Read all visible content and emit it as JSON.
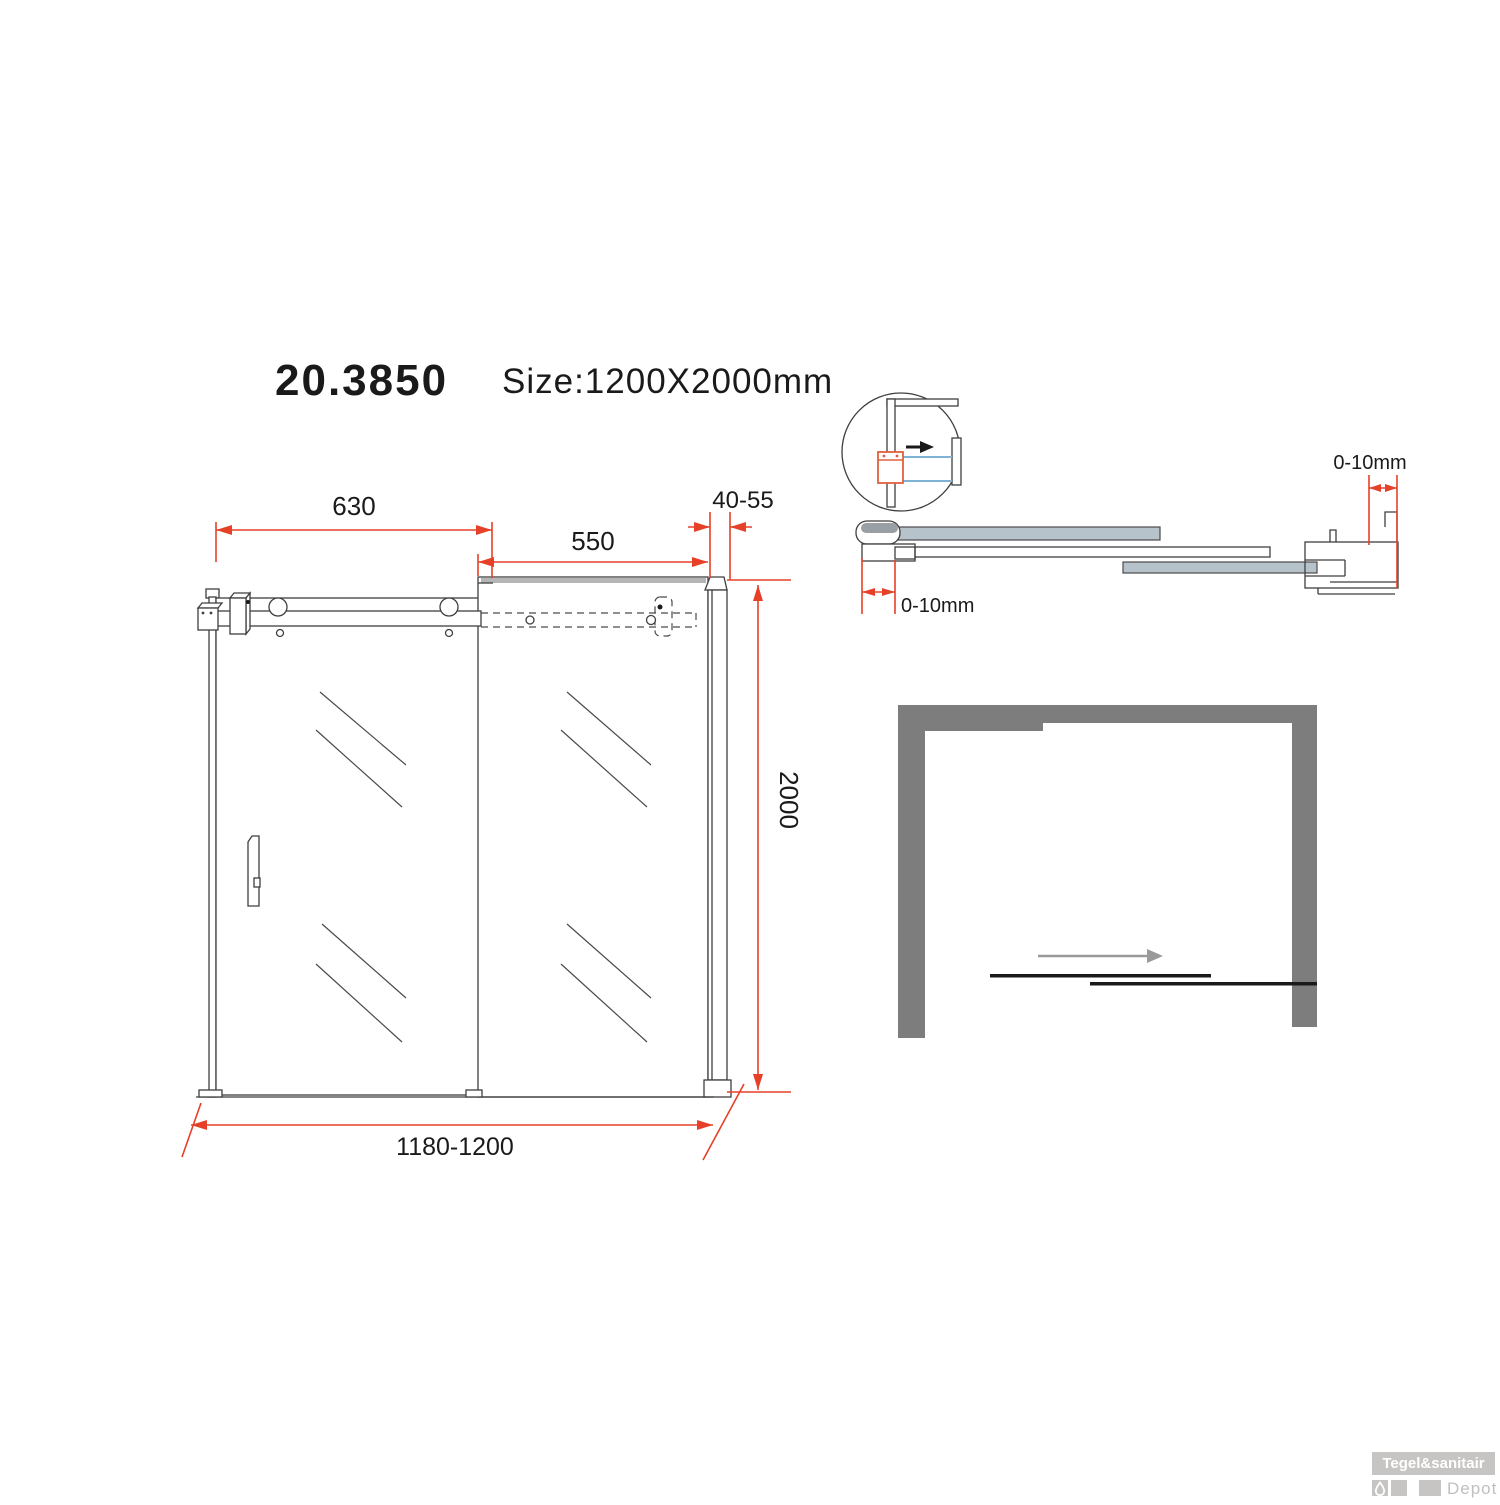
{
  "header": {
    "model": "20.3850",
    "size_label": "Size:1200X2000mm"
  },
  "front_view": {
    "dim_door_width": "630",
    "dim_fixed_width": "550",
    "dim_profile_width": "40-55",
    "dim_height": "2000",
    "dim_total_width": "1180-1200"
  },
  "section_view": {
    "dim_gap_top": "0-10mm",
    "dim_gap_bottom": "0-10mm"
  },
  "watermark": {
    "brand": "Tegel&sanitair",
    "sub_brand": "Depot"
  },
  "colors": {
    "dimension_red": "#e74029",
    "glass_fill": "#b7c3cb",
    "wall_gray": "#7d7d7d",
    "detail_blue": "#7fb2d4",
    "bracket_orange": "#e0603c",
    "logo_gray": "#c7c5c3",
    "line_color": "#3f3f3f"
  }
}
